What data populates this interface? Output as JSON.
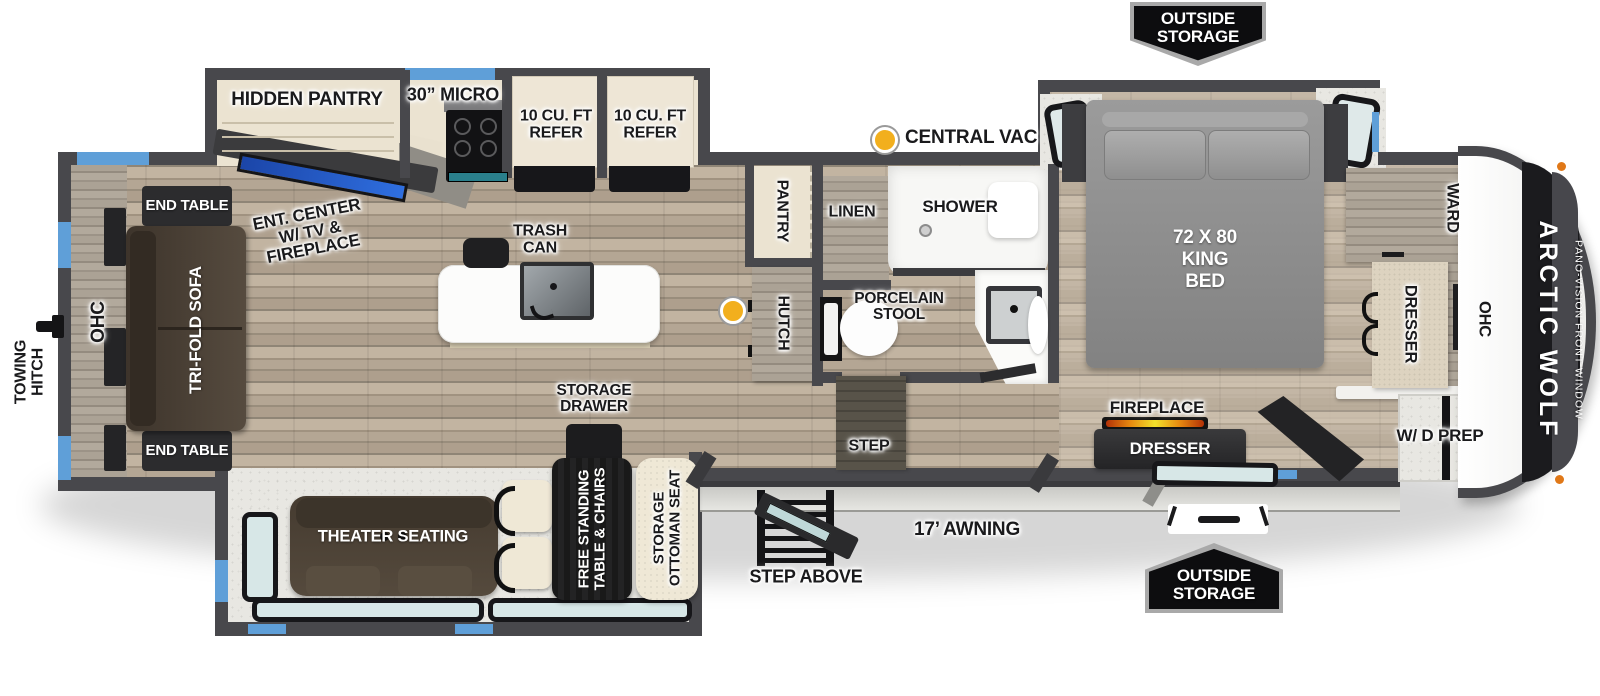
{
  "exterior": {
    "outside_storage_top": "OUTSIDE\nSTORAGE",
    "outside_storage_bottom": "OUTSIDE\nSTORAGE",
    "awning": "17’ AWNING",
    "step_above": "STEP ABOVE",
    "towing_hitch": "TOWING\nHITCH",
    "brand": "ARCTIC WOLF",
    "front_window": "PANO-VISION FRONT WINDOW"
  },
  "living": {
    "ohc": "OHC",
    "end_table_top": "END TABLE",
    "end_table_bottom": "END TABLE",
    "sofa": "TRI-FOLD SOFA",
    "ent_center": "ENT. CENTER\nW/ TV &\nFIREPLACE",
    "theater_seating": "THEATER SEATING",
    "free_standing_table": "FREE STANDING\nTABLE & CHAIRS",
    "storage_ottoman": "STORAGE\nOTTOMAN SEAT",
    "storage_drawer": "STORAGE\nDRAWER"
  },
  "kitchen": {
    "hidden_pantry": "HIDDEN PANTRY",
    "micro": "30” MICRO",
    "refer_left": "10 CU. FT\nREFER",
    "refer_right": "10 CU. FT\nREFER",
    "trash_can": "TRASH\nCAN",
    "pantry": "PANTRY",
    "hutch": "HUTCH",
    "central_vac": "CENTRAL VAC"
  },
  "bath": {
    "linen": "LINEN",
    "shower": "SHOWER",
    "toilet": "PORCELAIN\nSTOOL",
    "step": "STEP"
  },
  "bedroom": {
    "bed": "72 X 80\nKING\nBED",
    "ward": "WARD",
    "dresser": "DRESSER",
    "ohc": "OHC",
    "fireplace": "FIREPLACE",
    "dresser2": "DRESSER",
    "wd_prep": "W/ D PREP"
  },
  "colors": {
    "wall": "#48484c",
    "accent_blue": "#5f9fd8",
    "vac_yellow": "#f2af1d",
    "tv_blue": "#2f6fe0",
    "fireplace_glow": "#e8740f"
  }
}
